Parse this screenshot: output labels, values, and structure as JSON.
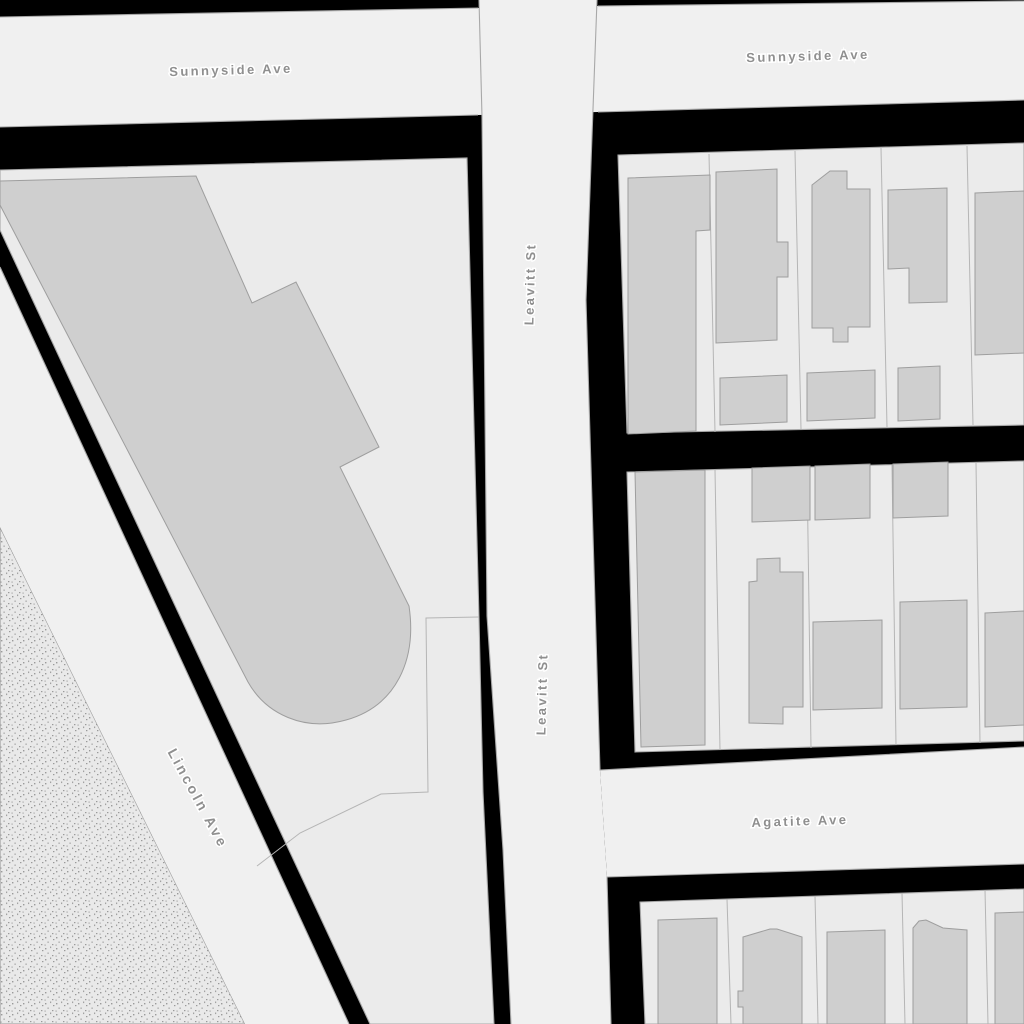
{
  "map": {
    "kind": "street-map",
    "street_labels": {
      "sunnyside_west": "Sunnyside Ave",
      "sunnyside_east": "Sunnyside Ave",
      "leavitt_north": "Leavitt St",
      "leavitt_south": "Leavitt St",
      "lincoln": "Lincoln Ave",
      "agatite": "Agatite Ave"
    },
    "features": {
      "roads": [
        "Sunnyside Ave",
        "Leavitt St",
        "Lincoln Ave",
        "Agatite Ave"
      ],
      "texture_area": "stippled-open-space-southwest-corner",
      "building_count_visible": 24
    },
    "colors": {
      "background": "#000000",
      "road": "#f0f0f0",
      "block": "#ebebeb",
      "building": "#cfcfcf",
      "outline": "#a8a8a8",
      "label_text": "#8f8f8f",
      "label_halo": "#ffffff",
      "texture_base": "#e9e9e9",
      "texture_dots": "#8f8f8f"
    }
  }
}
